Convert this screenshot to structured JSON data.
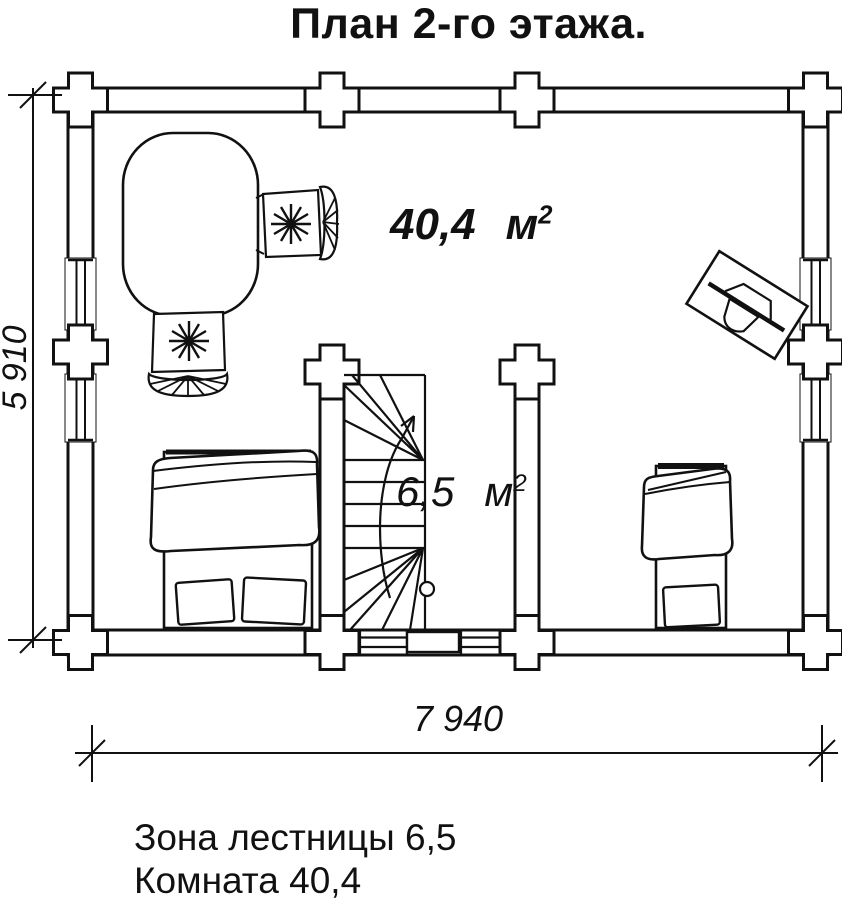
{
  "title": "План 2-го этажа.",
  "plan": {
    "room": {
      "area": "40,4",
      "unit": "м",
      "sup": "2"
    },
    "stairs": {
      "area": "6,5",
      "unit": "м",
      "sup": "2"
    }
  },
  "dimensions": {
    "horizontal": "7 940",
    "vertical": "5 910"
  },
  "legend": [
    {
      "text": "Зона лестницы 6,5"
    },
    {
      "text": "Комната 40,4"
    }
  ],
  "colors": {
    "ink": "#111111",
    "paper": "#ffffff"
  },
  "furniture": {
    "dining_table": "dining-table-with-two-wicker-chairs",
    "double_bed": "double-bed-with-pillows",
    "single_bed": "single-bed-with-pillow",
    "desk": "rotated-desk-with-chair",
    "stairs": "winder-staircase-up-arrow"
  }
}
